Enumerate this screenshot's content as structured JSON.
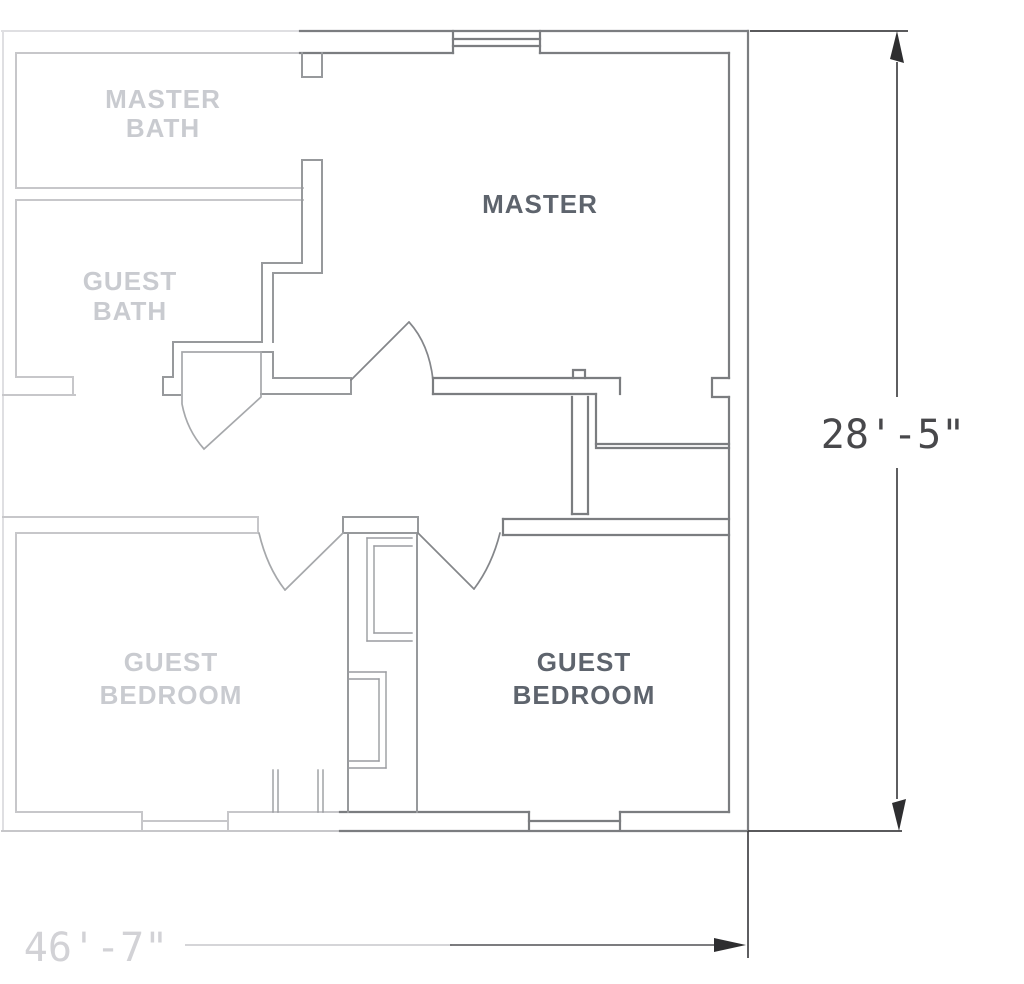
{
  "drawing": {
    "type": "architectural-floor-plan",
    "rooms": {
      "master_bath": {
        "line1": "MASTER",
        "line2": "BATH",
        "tone": "faded"
      },
      "guest_bath": {
        "line1": "GUEST",
        "line2": "BATH",
        "tone": "faded"
      },
      "master": {
        "line1": "MASTER",
        "tone": "dark"
      },
      "guest_bedroom_left": {
        "line1": "GUEST",
        "line2": "BEDROOM",
        "tone": "faded"
      },
      "guest_bedroom_right": {
        "line1": "GUEST",
        "line2": "BEDROOM",
        "tone": "dark"
      }
    },
    "dimensions": {
      "right_height": "28'-5\"",
      "bottom_width": "46'-7\""
    },
    "features": {
      "windows": 3,
      "door_swings": 4
    },
    "colors": {
      "wall_dark": "#7b7d80",
      "wall_faded": "#c7c7ca",
      "label_dark": "#5e646d",
      "label_faded": "#c9cbd0",
      "dimension_dark": "#48484b",
      "dimension_faded": "#d2d2d6",
      "background": "#ffffff"
    }
  }
}
